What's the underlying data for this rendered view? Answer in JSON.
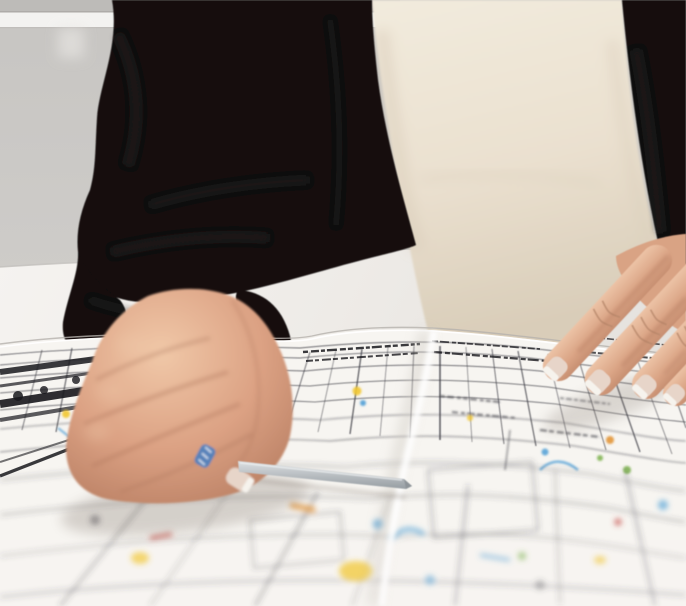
{
  "scene": {
    "alt": "Photo: person in black blazer over cream blouse at a white desk, left hand holding a silver pen pointing at a folded architectural floor plan, right-hand fingertips resting on the drawing"
  },
  "palette": {
    "wall_top": "#bdbbb8",
    "wall_band": "#f3f2f0",
    "wall": "#cdcbc8",
    "table": "#f2f0ed",
    "table_edge": "#c2bfbb",
    "blazer": "#121111",
    "blazer_fold": "#2b2826",
    "blouse": "#ece3d3",
    "skin": "#d9a384",
    "skin_light": "#eec7a8",
    "skin_shadow": "#b27a5f",
    "nail": "#e7d5c9",
    "nail_tip": "#f6f3ed",
    "paper": "#f7f5f1",
    "paper_fold_light": "#ffffff",
    "paper_fold_shadow": "#cfcac3",
    "ink": "#3c3c44",
    "ink_heavy": "#17171c",
    "ink_light": "#8b8b92",
    "mark_blue": "#4f9fd6",
    "mark_yellow": "#f2c832",
    "mark_orange": "#e2902e",
    "mark_green": "#7cb24e",
    "mark_red": "#c44b44",
    "pen_grip_blue": "#4a7fc0",
    "pen": "#b9bec2",
    "pen_dark": "#8e9499",
    "shadow": "#6b5d52"
  }
}
